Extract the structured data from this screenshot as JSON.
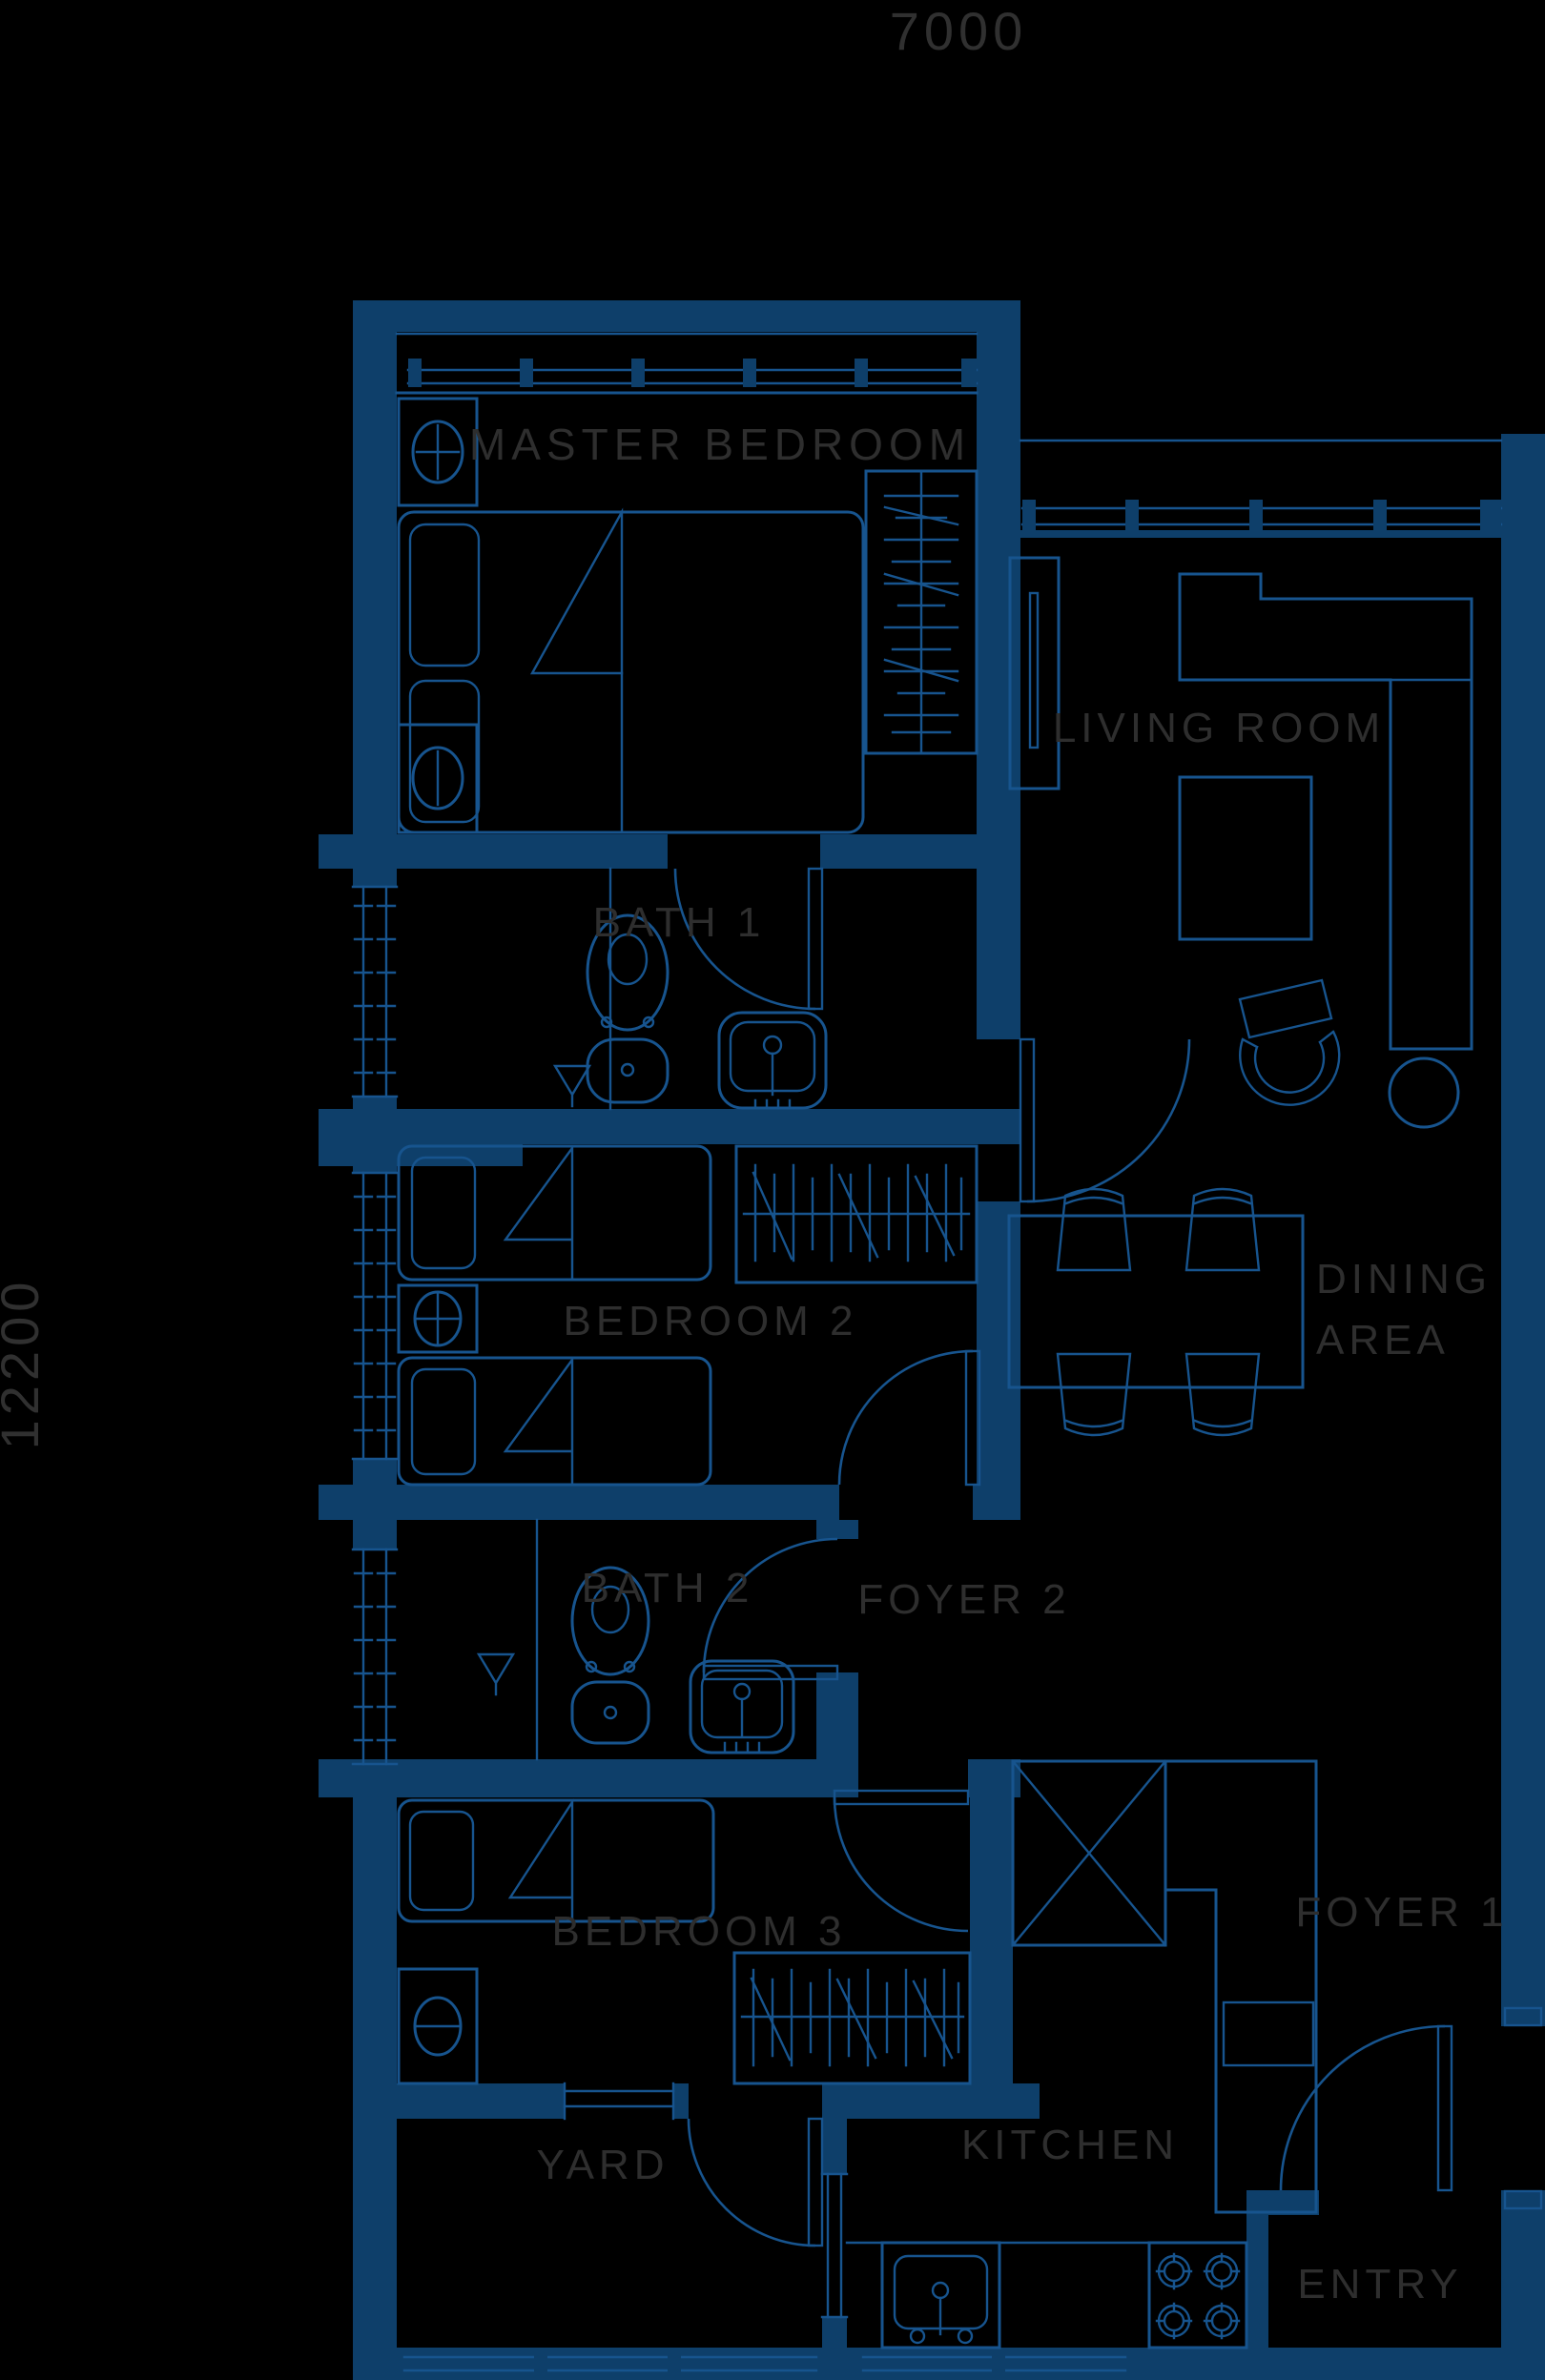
{
  "plan": {
    "type": "apartment-floor-plan",
    "style": "blueprint-dark",
    "colors": {
      "background": "#000000",
      "wall": "#0e3f6a",
      "line": "#17548e",
      "label": "#2e2e2e"
    },
    "dimensions": {
      "width_label": "7000",
      "height_label": "12200"
    },
    "rooms": {
      "master_bedroom": "MASTER BEDROOM",
      "living_room": "LIVING ROOM",
      "bath1": "BATH 1",
      "bedroom2": "BEDROOM 2",
      "dining_line1": "DINING",
      "dining_line2": "AREA",
      "bath2": "BATH 2",
      "foyer2": "FOYER 2",
      "bedroom3": "BEDROOM 3",
      "foyer1": "FOYER 1",
      "yard": "YARD",
      "kitchen": "KITCHEN",
      "entry": "ENTRY"
    },
    "symbols": [
      "double-bed",
      "single-bed",
      "pillow",
      "nightstand",
      "table-lamp",
      "wardrobe",
      "toilet",
      "washbasin",
      "shower-drain",
      "sectional-sofa",
      "tv-console",
      "coffee-table",
      "round-armchair",
      "side-table",
      "dining-table",
      "dining-chair",
      "gas-stove",
      "kitchen-sink",
      "fridge",
      "duct-shaft",
      "door-swing",
      "window"
    ]
  }
}
